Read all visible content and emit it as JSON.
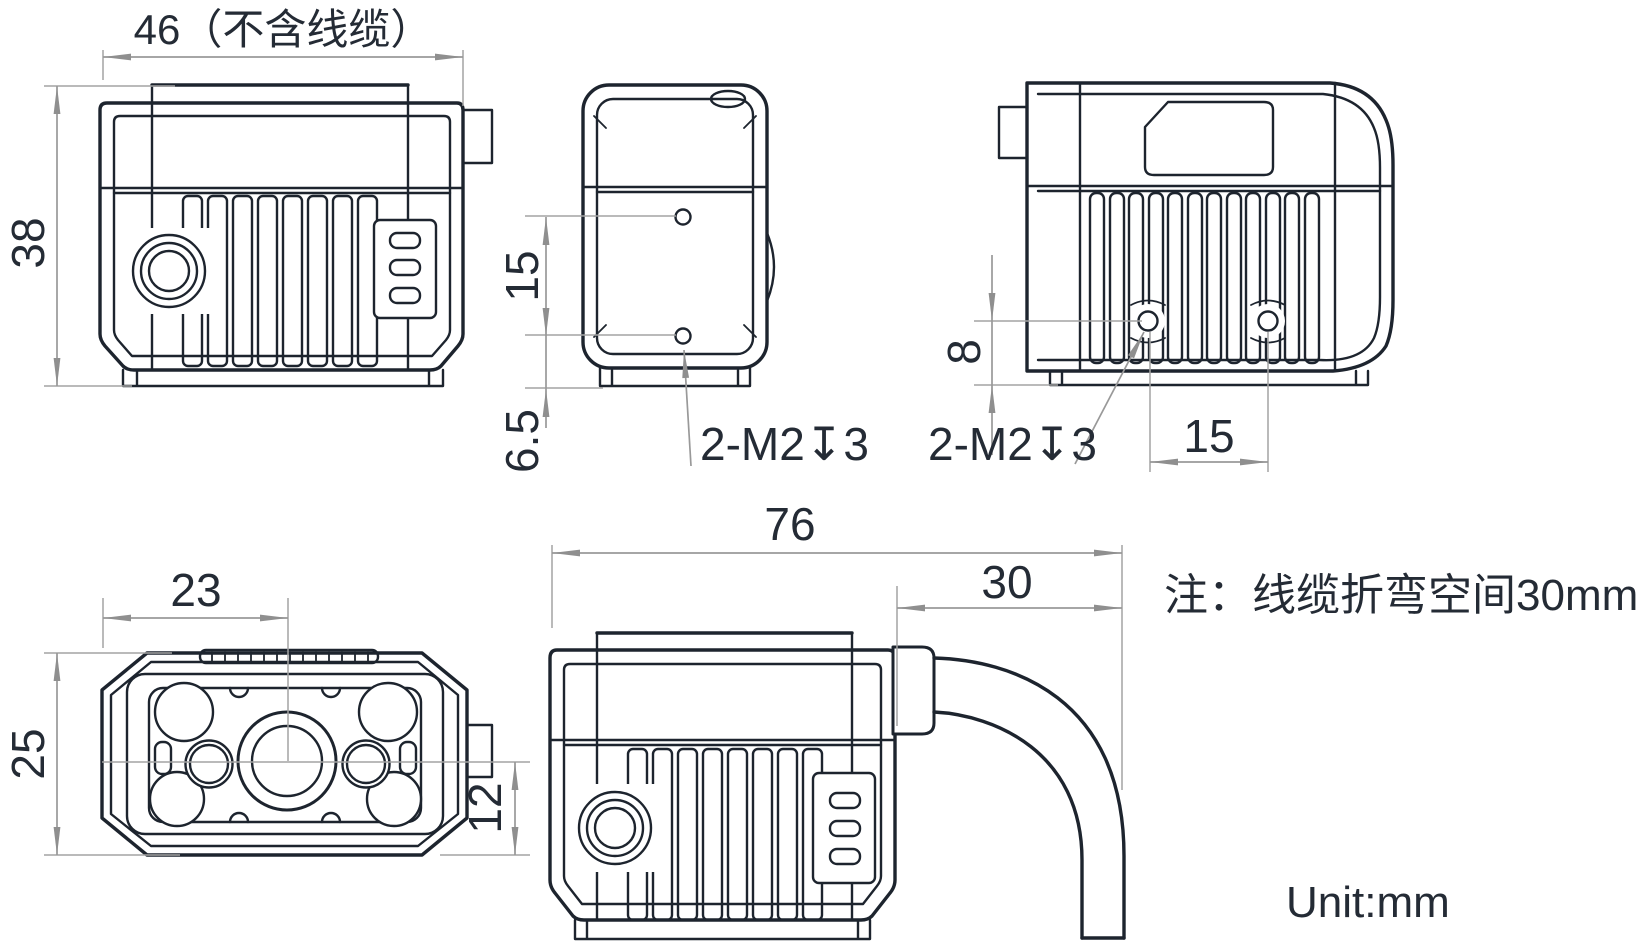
{
  "note": "注：线缆折弯空间30mm",
  "unit": "Unit:mm",
  "colors": {
    "line": "#1d242e",
    "dimension": "#999999",
    "text": "#242b35",
    "background": "#ffffff"
  },
  "views": {
    "side": {
      "dims": {
        "width": "46（不含线缆）",
        "height": "38"
      }
    },
    "bottom": {
      "dims": {
        "hole_spacing": "15",
        "hole_to_edge": "6.5",
        "thread": "2-M2↧3"
      }
    },
    "rear": {
      "dims": {
        "hole_to_base": "8",
        "hole_spacing": "15",
        "thread": "2-M2↧3"
      }
    },
    "front": {
      "dims": {
        "lens_center_from_left": "23",
        "depth": "25",
        "lens_center_to_bottom": "12"
      }
    },
    "cable": {
      "dims": {
        "total_length": "76",
        "bend_space": "30"
      }
    }
  }
}
